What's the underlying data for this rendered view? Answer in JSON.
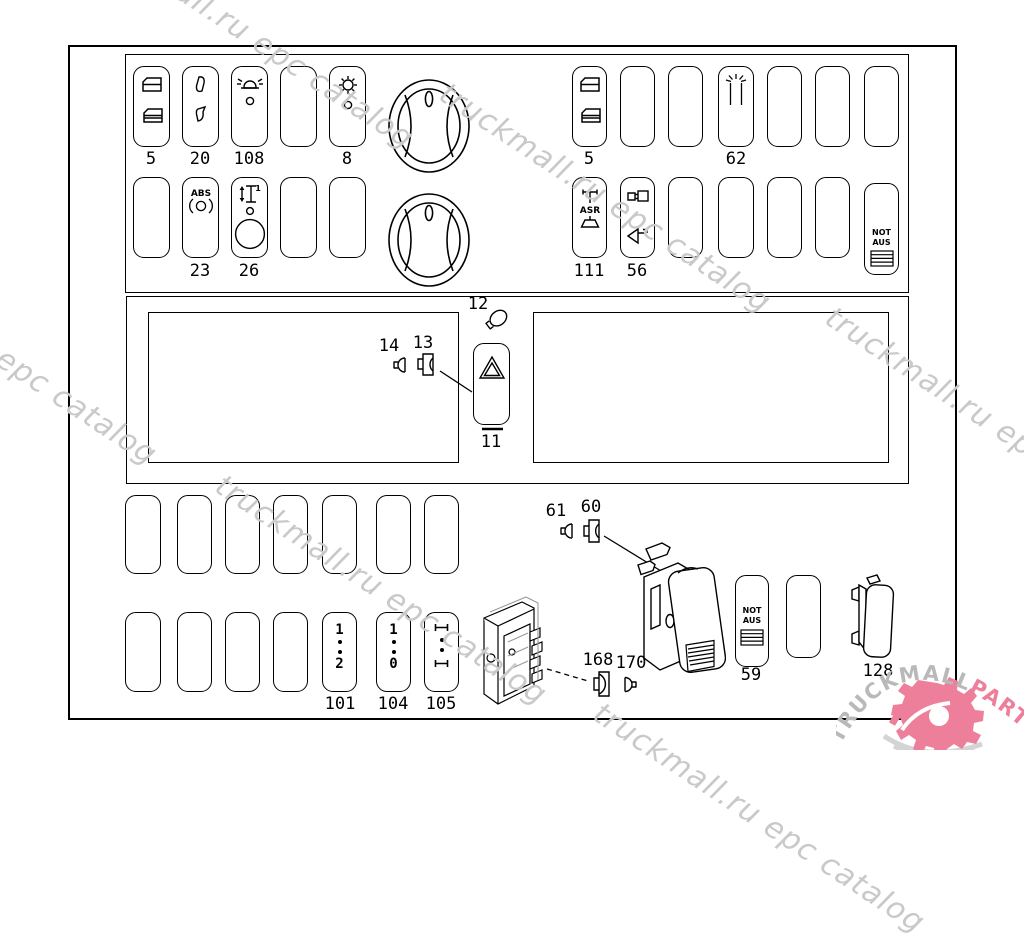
{
  "watermark": {
    "text": "truckmall.ru epc catalog",
    "color": "#c9c9c9"
  },
  "logo": {
    "text_gray": "TRUCKMALL",
    "text_pink": "PARTS",
    "gray": "#b9b9b9",
    "pink": "#ee7f9b"
  },
  "top_left_panel": {
    "row1_labels": {
      "s1": "5",
      "s2": "20",
      "s3": "108",
      "s5": "8"
    },
    "row2_labels": {
      "s2": "23",
      "s3": "26"
    },
    "abs_text": "ABS",
    "axle_one": "1",
    "icons": [
      "window-lift-icon",
      "mirror-adjust-icon",
      "beacon-icon",
      "blank",
      "heater-fan-icon",
      "abs-icon",
      "axle-lift-icon"
    ]
  },
  "top_right_panel": {
    "row1_labels": {
      "s1": "5",
      "s4": "62"
    },
    "row2_labels": {
      "s1": "111",
      "s2": "56"
    },
    "asr_text": "ASR",
    "not_aus": {
      "line1": "NOT",
      "line2": "AUS"
    },
    "icons": [
      "window-lift-icon",
      "interior-lamp-icon",
      "asr-icon",
      "horn-coupling-icon",
      "emergency-stop-hatch-icon"
    ]
  },
  "middle_section": {
    "item_labels": {
      "i11": "11",
      "i12": "12",
      "i13": "13",
      "i14": "14"
    },
    "icons": [
      "hazard-triangle-icon",
      "bulb-icon",
      "bulb-socket-icon",
      "bulb-icon"
    ]
  },
  "bottom_grid": {
    "labels": {
      "s101": "101",
      "s104": "104",
      "s105": "105"
    },
    "sw101": {
      "top": "1",
      "bottom": "2"
    },
    "sw104": {
      "top": "1",
      "bottom": "0"
    },
    "sw105_icon": "i-beam-positions-icon"
  },
  "bottom_parts": {
    "labels": {
      "i61": "61",
      "i60": "60",
      "i168": "168",
      "i170": "170",
      "i59": "59",
      "i128": "128"
    },
    "not_aus": {
      "line1": "NOT",
      "line2": "AUS"
    },
    "icons": [
      "bulb-icon",
      "bulb-socket-icon",
      "rocker-switch-3d",
      "connector-block-3d",
      "blank-switch-3d"
    ]
  }
}
